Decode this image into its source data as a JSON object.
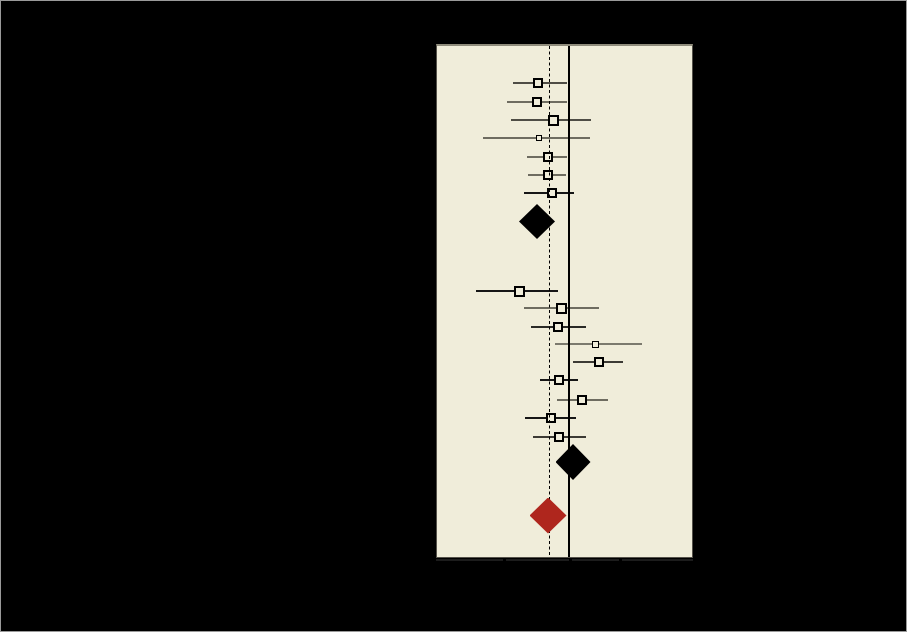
{
  "figure": {
    "width": 907,
    "height": 632,
    "background": "#000000",
    "border_color": "#9a9a9a"
  },
  "plot": {
    "left": 435,
    "top": 43,
    "width": 257,
    "height": 514,
    "fill": "#f0edda",
    "frame_top_color": "#8f8c7c",
    "frame_side_color": "#55524a",
    "axis": {
      "y": 558,
      "height": 2,
      "color": "#1c1c1c",
      "x_start": 435,
      "x_end": 692,
      "ticks": [
        503,
        569,
        619
      ],
      "tick_color": "#000000",
      "tick_gap": 3,
      "tick_len": 4
    }
  },
  "chart_data": {
    "type": "forest",
    "note": "Meta-analysis forest plot drawn on a black background. Study names, statistics columns and axis tick labels are rendered black-on-black and are not visible in the pixels; only the plot panel markers are visible. All values are pixel coordinates measured from the screenshot. Square size is proportional to study weight.",
    "reference_lines": [
      {
        "name": "no-effect-line",
        "style": "solid",
        "x": 568,
        "width": 2,
        "color": "#000000"
      },
      {
        "name": "pooled-estimate-line",
        "style": "dashed",
        "x": 548,
        "width": 1,
        "color": "#000000",
        "dash": 3,
        "gap": 2.5
      }
    ],
    "groups": [
      {
        "name": "subgroup-1",
        "studies": [
          {
            "y": 82,
            "x": 537,
            "ci": [
              512,
              566
            ],
            "size": 10,
            "line_color": "#4f4d45"
          },
          {
            "y": 101,
            "x": 536,
            "ci": [
              506,
              566
            ],
            "size": 10,
            "line_color": "#6e6c60"
          },
          {
            "y": 119,
            "x": 552,
            "ci": [
              510,
              590
            ],
            "size": 11,
            "line_color": "#4f4d45"
          },
          {
            "y": 137,
            "x": 538,
            "ci": [
              482,
              589
            ],
            "size": 6,
            "line_color": "#6e6c60"
          },
          {
            "y": 156,
            "x": 547,
            "ci": [
              526,
              566
            ],
            "size": 10,
            "line_color": "#6e6c60"
          },
          {
            "y": 174,
            "x": 547,
            "ci": [
              527,
              565
            ],
            "size": 10,
            "line_color": "#6e6c60"
          },
          {
            "y": 192,
            "x": 551,
            "ci": [
              523,
              573
            ],
            "size": 10,
            "line_color": "#161616"
          }
        ],
        "summary_diamond": {
          "x": 536,
          "y": 220.5,
          "half_w": 18,
          "half_h": 17.5,
          "color": "#000000"
        }
      },
      {
        "name": "subgroup-2",
        "studies": [
          {
            "y": 290,
            "x": 518,
            "ci": [
              475,
              557
            ],
            "size": 11,
            "line_color": "#161616"
          },
          {
            "y": 307,
            "x": 560,
            "ci": [
              523,
              598
            ],
            "size": 11,
            "line_color": "#6e6c60"
          },
          {
            "y": 326,
            "x": 557,
            "ci": [
              530,
              585
            ],
            "size": 10,
            "line_color": "#2a2a26"
          },
          {
            "y": 343,
            "x": 594,
            "ci": [
              554,
              641
            ],
            "size": 7,
            "line_color": "#7c7a6e"
          },
          {
            "y": 361,
            "x": 598,
            "ci": [
              572,
              622
            ],
            "size": 10,
            "line_color": "#3c3a34"
          },
          {
            "y": 379,
            "x": 558,
            "ci": [
              539,
              577
            ],
            "size": 10,
            "line_color": "#161616"
          },
          {
            "y": 399,
            "x": 581,
            "ci": [
              556,
              607
            ],
            "size": 10,
            "line_color": "#6e6c60"
          },
          {
            "y": 417,
            "x": 550,
            "ci": [
              524,
              575
            ],
            "size": 10,
            "line_color": "#161616"
          },
          {
            "y": 436,
            "x": 558,
            "ci": [
              532,
              585
            ],
            "size": 10,
            "line_color": "#3c3a34"
          }
        ],
        "summary_diamond": {
          "x": 572,
          "y": 461,
          "half_w": 17.5,
          "half_h": 18,
          "color": "#000000"
        }
      }
    ],
    "overall_diamond": {
      "x": 547,
      "y": 514.5,
      "half_w": 18.5,
      "half_h": 18,
      "color": "#af261d"
    },
    "square_border_color": "#000000"
  }
}
